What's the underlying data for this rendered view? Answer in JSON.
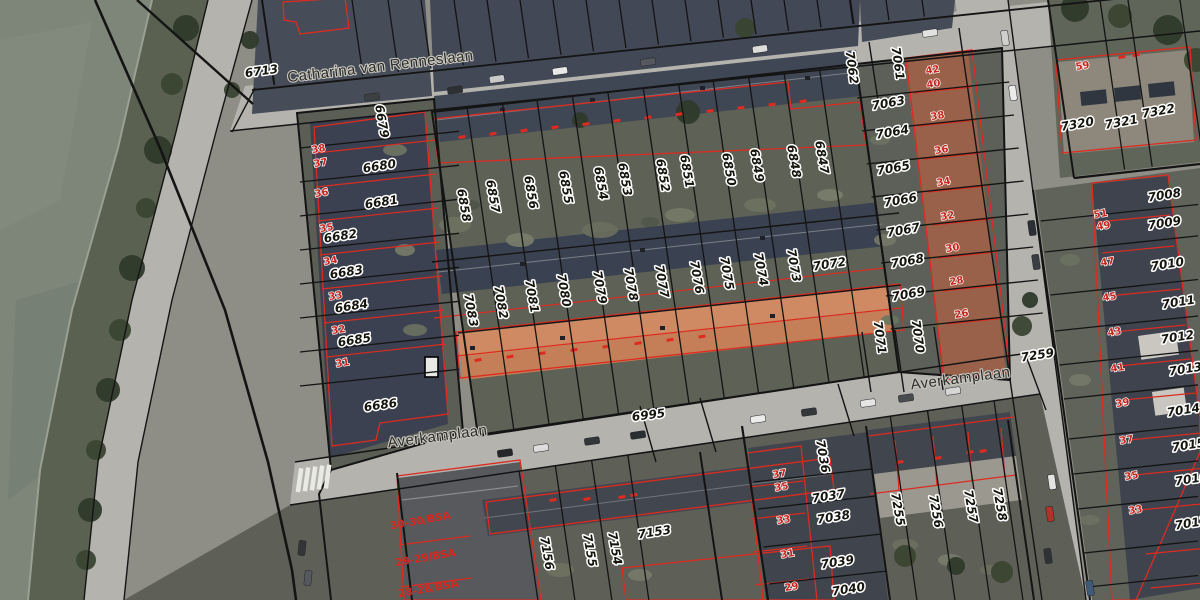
{
  "map": {
    "colors": {
      "water": "#7d8678",
      "vegetation": "#5a6150",
      "street": "#b4b3ae",
      "roof_dark": "#3f4654",
      "roof_tile_orange": "#c47e58",
      "parcel_line": "#141414",
      "building_outline": "#dd2b20",
      "label_fill": "#15150e",
      "label_halo": "#ffffff",
      "house_number": "#c8231a"
    },
    "streets": [
      {
        "name": "Catharina van Renneslaan",
        "x": 381,
        "y": 71,
        "r": -6.8
      },
      {
        "name": "Averkamplaan",
        "x": 961,
        "y": 383,
        "r": -7.5
      },
      {
        "name": "Averkamplaan",
        "x": 438,
        "y": 441,
        "r": -7.5
      }
    ],
    "parcels": [
      {
        "t": "6713",
        "x": 262,
        "y": 75,
        "r": -8
      },
      {
        "t": "6679",
        "x": 378,
        "y": 122,
        "r": 80
      },
      {
        "t": "6680",
        "x": 380,
        "y": 170,
        "r": -9
      },
      {
        "t": "6681",
        "x": 382,
        "y": 206,
        "r": -9
      },
      {
        "t": "6682",
        "x": 341,
        "y": 240,
        "r": -9
      },
      {
        "t": "6683",
        "x": 347,
        "y": 276,
        "r": -9
      },
      {
        "t": "6684",
        "x": 352,
        "y": 310,
        "r": -9
      },
      {
        "t": "6685",
        "x": 355,
        "y": 344,
        "r": -9
      },
      {
        "t": "6686",
        "x": 381,
        "y": 409,
        "r": -8
      },
      {
        "t": "6858",
        "x": 460,
        "y": 206,
        "r": 80
      },
      {
        "t": "6857",
        "x": 489,
        "y": 197,
        "r": 80
      },
      {
        "t": "6856",
        "x": 527,
        "y": 193,
        "r": 80
      },
      {
        "t": "6855",
        "x": 562,
        "y": 188,
        "r": 80
      },
      {
        "t": "6854",
        "x": 597,
        "y": 184,
        "r": 80
      },
      {
        "t": "6853",
        "x": 621,
        "y": 180,
        "r": 80
      },
      {
        "t": "6852",
        "x": 659,
        "y": 176,
        "r": 80
      },
      {
        "t": "6851",
        "x": 683,
        "y": 172,
        "r": 80
      },
      {
        "t": "6850",
        "x": 725,
        "y": 170,
        "r": 80
      },
      {
        "t": "6849",
        "x": 753,
        "y": 166,
        "r": 80
      },
      {
        "t": "6848",
        "x": 790,
        "y": 162,
        "r": 80
      },
      {
        "t": "6847",
        "x": 818,
        "y": 158,
        "r": 80
      },
      {
        "t": "7083",
        "x": 467,
        "y": 311,
        "r": 80
      },
      {
        "t": "7082",
        "x": 497,
        "y": 303,
        "r": 80
      },
      {
        "t": "7081",
        "x": 528,
        "y": 297,
        "r": 80
      },
      {
        "t": "7080",
        "x": 560,
        "y": 291,
        "r": 80
      },
      {
        "t": "7079",
        "x": 596,
        "y": 288,
        "r": 80
      },
      {
        "t": "7078",
        "x": 627,
        "y": 285,
        "r": 80
      },
      {
        "t": "7077",
        "x": 658,
        "y": 282,
        "r": 80
      },
      {
        "t": "7076",
        "x": 693,
        "y": 278,
        "r": 80
      },
      {
        "t": "7075",
        "x": 723,
        "y": 274,
        "r": 80
      },
      {
        "t": "7074",
        "x": 757,
        "y": 270,
        "r": 80
      },
      {
        "t": "7073",
        "x": 790,
        "y": 266,
        "r": 80
      },
      {
        "t": "7072",
        "x": 830,
        "y": 268,
        "r": -9
      },
      {
        "t": "7062",
        "x": 848,
        "y": 68,
        "r": 82
      },
      {
        "t": "7061",
        "x": 894,
        "y": 64,
        "r": 82
      },
      {
        "t": "7063",
        "x": 889,
        "y": 107,
        "r": -10
      },
      {
        "t": "7064",
        "x": 893,
        "y": 136,
        "r": -10
      },
      {
        "t": "7065",
        "x": 894,
        "y": 172,
        "r": -10
      },
      {
        "t": "7066",
        "x": 901,
        "y": 204,
        "r": -10
      },
      {
        "t": "7067",
        "x": 904,
        "y": 234,
        "r": -10
      },
      {
        "t": "7068",
        "x": 908,
        "y": 265,
        "r": -10
      },
      {
        "t": "7069",
        "x": 909,
        "y": 298,
        "r": -10
      },
      {
        "t": "7071",
        "x": 876,
        "y": 338,
        "r": 82
      },
      {
        "t": "7070",
        "x": 914,
        "y": 337,
        "r": 82
      },
      {
        "t": "7320",
        "x": 1078,
        "y": 128,
        "r": -10
      },
      {
        "t": "7321",
        "x": 1122,
        "y": 126,
        "r": -10
      },
      {
        "t": "7322",
        "x": 1159,
        "y": 115,
        "r": -10
      },
      {
        "t": "7008",
        "x": 1165,
        "y": 199,
        "r": -9
      },
      {
        "t": "7009",
        "x": 1165,
        "y": 227,
        "r": -9
      },
      {
        "t": "7010",
        "x": 1168,
        "y": 268,
        "r": -9
      },
      {
        "t": "7011",
        "x": 1179,
        "y": 306,
        "r": -9
      },
      {
        "t": "7012",
        "x": 1178,
        "y": 341,
        "r": -9
      },
      {
        "t": "7013",
        "x": 1186,
        "y": 373,
        "r": -9
      },
      {
        "t": "7014",
        "x": 1184,
        "y": 414,
        "r": -9
      },
      {
        "t": "7015",
        "x": 1189,
        "y": 449,
        "r": -9
      },
      {
        "t": "7016",
        "x": 1192,
        "y": 483,
        "r": -9
      },
      {
        "t": "7017",
        "x": 1192,
        "y": 527,
        "r": -9
      },
      {
        "t": "7259",
        "x": 1038,
        "y": 359,
        "r": -9
      },
      {
        "t": "6995",
        "x": 649,
        "y": 419,
        "r": -7
      },
      {
        "t": "7156",
        "x": 543,
        "y": 554,
        "r": 80
      },
      {
        "t": "7155",
        "x": 586,
        "y": 551,
        "r": 80
      },
      {
        "t": "7154",
        "x": 611,
        "y": 549,
        "r": 80
      },
      {
        "t": "7153",
        "x": 655,
        "y": 536,
        "r": -9
      },
      {
        "t": "7036",
        "x": 819,
        "y": 457,
        "r": 80
      },
      {
        "t": "7037",
        "x": 829,
        "y": 500,
        "r": -9
      },
      {
        "t": "7038",
        "x": 834,
        "y": 521,
        "r": -9
      },
      {
        "t": "7039",
        "x": 838,
        "y": 566,
        "r": -9
      },
      {
        "t": "7040",
        "x": 849,
        "y": 593,
        "r": -9
      },
      {
        "t": "7255",
        "x": 894,
        "y": 510,
        "r": 80
      },
      {
        "t": "7256",
        "x": 932,
        "y": 512,
        "r": 80
      },
      {
        "t": "7257",
        "x": 967,
        "y": 507,
        "r": 80
      },
      {
        "t": "7258",
        "x": 996,
        "y": 505,
        "r": 80
      }
    ],
    "houses": [
      {
        "t": "38",
        "x": 319,
        "y": 152
      },
      {
        "t": "37",
        "x": 321,
        "y": 166
      },
      {
        "t": "36",
        "x": 322,
        "y": 196
      },
      {
        "t": "35",
        "x": 327,
        "y": 231
      },
      {
        "t": "34",
        "x": 331,
        "y": 264
      },
      {
        "t": "33",
        "x": 336,
        "y": 299
      },
      {
        "t": "32",
        "x": 339,
        "y": 333
      },
      {
        "t": "31",
        "x": 343,
        "y": 366
      },
      {
        "t": "42",
        "x": 933,
        "y": 73
      },
      {
        "t": "40",
        "x": 934,
        "y": 87
      },
      {
        "t": "38",
        "x": 938,
        "y": 119
      },
      {
        "t": "36",
        "x": 942,
        "y": 153
      },
      {
        "t": "34",
        "x": 944,
        "y": 185
      },
      {
        "t": "32",
        "x": 948,
        "y": 219
      },
      {
        "t": "30",
        "x": 953,
        "y": 251
      },
      {
        "t": "28",
        "x": 957,
        "y": 284
      },
      {
        "t": "26",
        "x": 962,
        "y": 317
      },
      {
        "t": "59",
        "x": 1083,
        "y": 69
      },
      {
        "t": "51",
        "x": 1101,
        "y": 217
      },
      {
        "t": "49",
        "x": 1104,
        "y": 229
      },
      {
        "t": "47",
        "x": 1108,
        "y": 265
      },
      {
        "t": "45",
        "x": 1110,
        "y": 300
      },
      {
        "t": "43",
        "x": 1115,
        "y": 335
      },
      {
        "t": "41",
        "x": 1118,
        "y": 371
      },
      {
        "t": "39",
        "x": 1123,
        "y": 406
      },
      {
        "t": "37",
        "x": 1127,
        "y": 443
      },
      {
        "t": "35",
        "x": 1132,
        "y": 479
      },
      {
        "t": "33",
        "x": 1136,
        "y": 513
      },
      {
        "t": "37",
        "x": 780,
        "y": 477
      },
      {
        "t": "35",
        "x": 782,
        "y": 490
      },
      {
        "t": "33",
        "x": 784,
        "y": 523
      },
      {
        "t": "31",
        "x": 788,
        "y": 557
      },
      {
        "t": "29",
        "x": 792,
        "y": 590
      }
    ],
    "zones": [
      {
        "t": "30-30/BSA",
        "x": 421,
        "y": 524,
        "r": -10
      },
      {
        "t": "29-29/BSA",
        "x": 426,
        "y": 561,
        "r": -10
      },
      {
        "t": "28-28/BSA",
        "x": 429,
        "y": 592,
        "r": -10
      }
    ]
  }
}
